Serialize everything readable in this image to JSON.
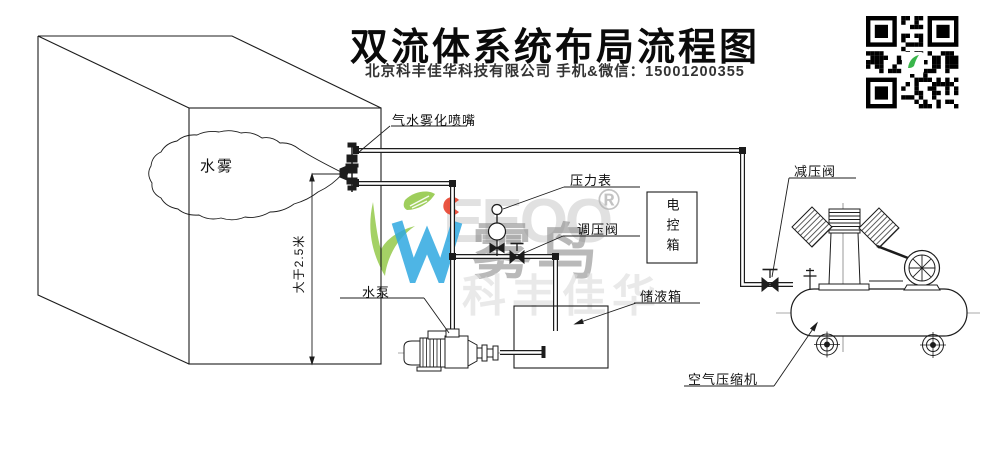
{
  "header": {
    "title": "双流体系统布局流程图",
    "subtitle": "北京科丰佳华科技有限公司 手机&微信：15001200355"
  },
  "diagram": {
    "room": {
      "mist_label": "水雾",
      "height_dimension": "大于2.5米"
    },
    "labels": {
      "nozzle": "气水雾化喷嘴",
      "pressure_gauge": "压力表",
      "regulating_valve": "调压阀",
      "control_box": "电控箱",
      "reducing_valve": "减压阀",
      "water_pump": "水泵",
      "storage_tank": "储液箱",
      "air_compressor": "空气压缩机"
    }
  },
  "watermark": {
    "brand_latin": "EEOO",
    "brand_cn": "雾鸟",
    "registered": "®",
    "company_cn": "科丰佳华",
    "colors": {
      "leaf_green": "#8dc63f",
      "logo_blue": "#2fa8e1",
      "logo_red": "#e8432e",
      "watermark_gray": "#9a9a9a",
      "line": "#1c1c1c"
    }
  }
}
